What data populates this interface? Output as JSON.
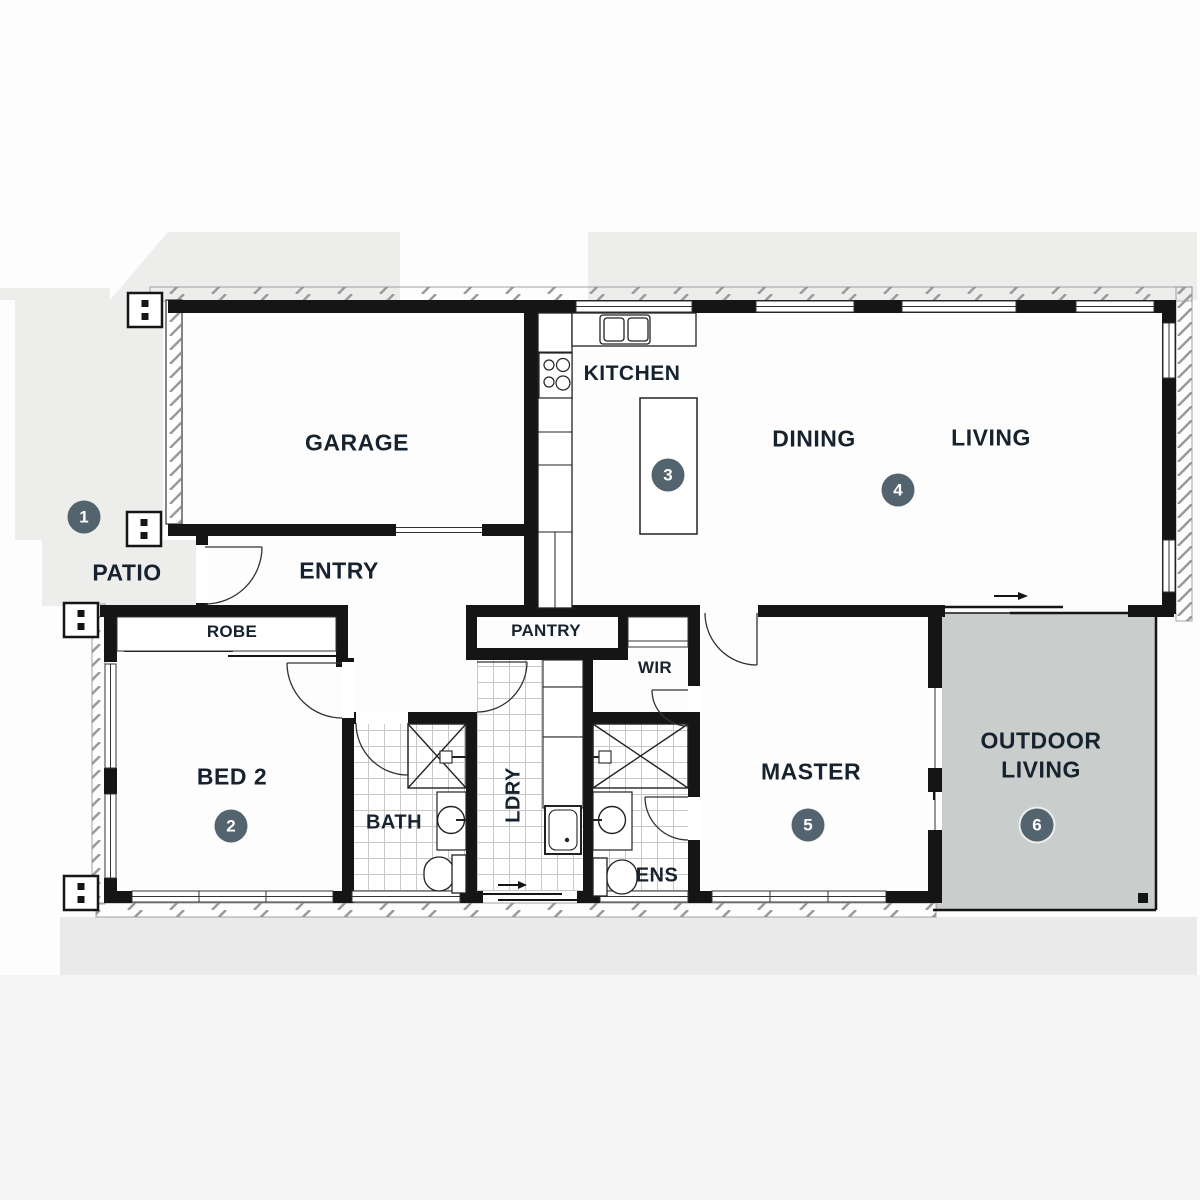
{
  "plan": {
    "type": "residential-floor-plan",
    "rooms": {
      "garage": {
        "label": "GARAGE"
      },
      "kitchen": {
        "label": "KITCHEN"
      },
      "dining": {
        "label": "DINING"
      },
      "living": {
        "label": "LIVING"
      },
      "entry": {
        "label": "ENTRY"
      },
      "patio": {
        "label": "PATIO"
      },
      "robe": {
        "label": "ROBE"
      },
      "bed2": {
        "label": "BED 2"
      },
      "bath": {
        "label": "BATH"
      },
      "laundry": {
        "label": "LDRY"
      },
      "pantry": {
        "label": "PANTRY"
      },
      "wir": {
        "label": "WIR"
      },
      "ens": {
        "label": "ENS"
      },
      "master": {
        "label": "MASTER"
      },
      "outdoor": {
        "label_line1": "OUTDOOR",
        "label_line2": "LIVING"
      }
    },
    "markers": [
      {
        "number": "1",
        "location": "patio"
      },
      {
        "number": "2",
        "location": "bed2"
      },
      {
        "number": "3",
        "location": "kitchen-island"
      },
      {
        "number": "4",
        "location": "dining-living"
      },
      {
        "number": "5",
        "location": "master"
      },
      {
        "number": "6",
        "location": "outdoor-living"
      }
    ],
    "colors": {
      "wall": "#151515",
      "marker_fill": "#54646f",
      "marker_text": "#ffffff",
      "outdoor_fill": "#c9cdcb",
      "shade_fill": "#ededec",
      "bottom_band_fill": "#e9eae9",
      "page_lower_fill": "#f4f5f4",
      "tile_line": "#c8c8c8",
      "label_text": "#16222e"
    }
  }
}
